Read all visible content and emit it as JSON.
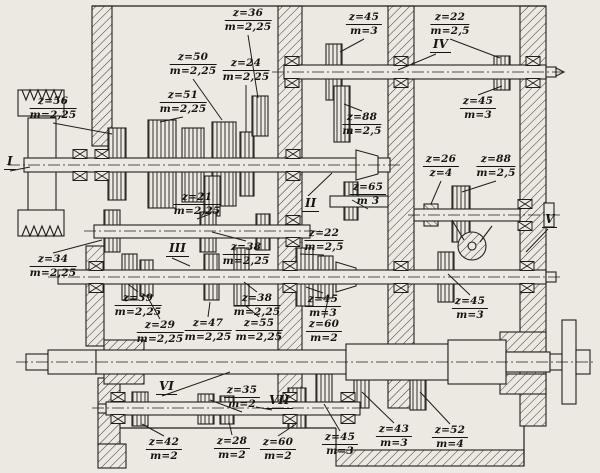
{
  "drawing": {
    "background": "#ece9e3",
    "ink": "#211e19",
    "kind": "gearbox-sectional-drawing"
  },
  "shaft_labels": [
    {
      "label": "I",
      "x": 4,
      "y": 155,
      "side": "down",
      "lx": 30,
      "ly": 167
    },
    {
      "label": "II",
      "x": 302,
      "y": 197,
      "side": "up",
      "lx": 332,
      "ly": 173
    },
    {
      "label": "III",
      "x": 166,
      "y": 242,
      "side": "down",
      "lx": 190,
      "ly": 266
    },
    {
      "label": "IV",
      "x": 430,
      "y": 38,
      "side": "down",
      "lx": 398,
      "ly": 70
    },
    {
      "label": "V",
      "x": 542,
      "y": 213,
      "side": "down",
      "lx": 526,
      "ly": 252
    },
    {
      "label": "VI",
      "x": 156,
      "y": 380,
      "side": "down",
      "lx": 230,
      "ly": 372
    },
    {
      "label": "VII",
      "x": 266,
      "y": 394,
      "side": "down",
      "lx": 256,
      "ly": 407
    }
  ],
  "gear_labels": [
    {
      "z": "z=36",
      "m": "m=2,25",
      "x": 248,
      "y": 8,
      "side": "down",
      "lx": 258,
      "ly": 98
    },
    {
      "z": "z=45",
      "m": "m=3",
      "x": 364,
      "y": 12,
      "side": "down",
      "lx": 340,
      "ly": 52
    },
    {
      "z": "z=22",
      "m": "m=2,5",
      "x": 450,
      "y": 12,
      "side": "down",
      "lx": 500,
      "ly": 58
    },
    {
      "z": "z=50",
      "m": "m=2,25",
      "x": 193,
      "y": 52,
      "side": "down",
      "lx": 222,
      "ly": 120
    },
    {
      "z": "z=24",
      "m": "m=2,25",
      "x": 246,
      "y": 58,
      "side": "down",
      "lx": 246,
      "ly": 132
    },
    {
      "z": "z=56",
      "m": "m=2,25",
      "x": 53,
      "y": 96,
      "side": "down",
      "lx": 112,
      "ly": 134
    },
    {
      "z": "z=51",
      "m": "m=2,25",
      "x": 183,
      "y": 90,
      "side": "down",
      "lx": 160,
      "ly": 122
    },
    {
      "z": "z=88",
      "m": "m=2,5",
      "x": 362,
      "y": 112,
      "side": "up",
      "lx": 344,
      "ly": 104
    },
    {
      "z": "z=45",
      "m": "m=3",
      "x": 478,
      "y": 96,
      "side": "up",
      "lx": 502,
      "ly": 86
    },
    {
      "z": "z=26",
      "m": "z=4",
      "x": 441,
      "y": 154,
      "side": "down",
      "lx": 431,
      "ly": 204
    },
    {
      "z": "z=88",
      "m": "m=2,5",
      "x": 496,
      "y": 154,
      "side": "down",
      "lx": 462,
      "ly": 192
    },
    {
      "z": "z=21",
      "m": "m=2,25",
      "x": 197,
      "y": 192,
      "side": "down",
      "lx": 210,
      "ly": 214
    },
    {
      "z": "z=65",
      "m": "m 3",
      "x": 368,
      "y": 182,
      "side": "down",
      "lx": 352,
      "ly": 200
    },
    {
      "z": "z=22",
      "m": "m=2,5",
      "x": 324,
      "y": 228,
      "side": "down",
      "lx": 300,
      "ly": 254
    },
    {
      "z": "z=38",
      "m": "m=2,25",
      "x": 246,
      "y": 242,
      "side": "up",
      "lx": 212,
      "ly": 232
    },
    {
      "z": "z=34",
      "m": "m=2,25",
      "x": 53,
      "y": 254,
      "side": "up",
      "lx": 102,
      "ly": 240
    },
    {
      "z": "z=39",
      "m": "m=2,25",
      "x": 138,
      "y": 293,
      "side": "up",
      "lx": 128,
      "ly": 284
    },
    {
      "z": "z=29",
      "m": "m=2,25",
      "x": 160,
      "y": 320,
      "side": "up",
      "lx": 148,
      "ly": 298
    },
    {
      "z": "z=47",
      "m": "m=2,25",
      "x": 208,
      "y": 318,
      "side": "up",
      "lx": 210,
      "ly": 302
    },
    {
      "z": "z=38",
      "m": "m=2,25",
      "x": 257,
      "y": 293,
      "side": "up",
      "lx": 244,
      "ly": 282
    },
    {
      "z": "z=55",
      "m": "m=2,25",
      "x": 259,
      "y": 318,
      "side": "up",
      "lx": 246,
      "ly": 306
    },
    {
      "z": "z=45",
      "m": "m=3",
      "x": 323,
      "y": 294,
      "side": "up",
      "lx": 306,
      "ly": 287
    },
    {
      "z": "z=60",
      "m": "m=2",
      "x": 324,
      "y": 319,
      "side": "up",
      "lx": 328,
      "ly": 299
    },
    {
      "z": "z=45",
      "m": "m=3",
      "x": 470,
      "y": 296,
      "side": "up",
      "lx": 448,
      "ly": 274
    },
    {
      "z": "z=35",
      "m": "m=2",
      "x": 242,
      "y": 385,
      "side": "down",
      "lx": 210,
      "ly": 400
    },
    {
      "z": "z=42",
      "m": "m=2",
      "x": 164,
      "y": 437,
      "side": "up",
      "lx": 142,
      "ly": 424
    },
    {
      "z": "z=28",
      "m": "m=2",
      "x": 232,
      "y": 436,
      "side": "up",
      "lx": 229,
      "ly": 422
    },
    {
      "z": "z=60",
      "m": "m=2",
      "x": 278,
      "y": 437,
      "side": "up",
      "lx": 296,
      "ly": 424
    },
    {
      "z": "z=45",
      "m": "m=3",
      "x": 340,
      "y": 432,
      "side": "up",
      "lx": 324,
      "ly": 404
    },
    {
      "z": "z=43",
      "m": "m=3",
      "x": 394,
      "y": 424,
      "side": "up",
      "lx": 362,
      "ly": 392
    },
    {
      "z": "z=52",
      "m": "m=4",
      "x": 450,
      "y": 425,
      "side": "up",
      "lx": 420,
      "ly": 392
    }
  ]
}
